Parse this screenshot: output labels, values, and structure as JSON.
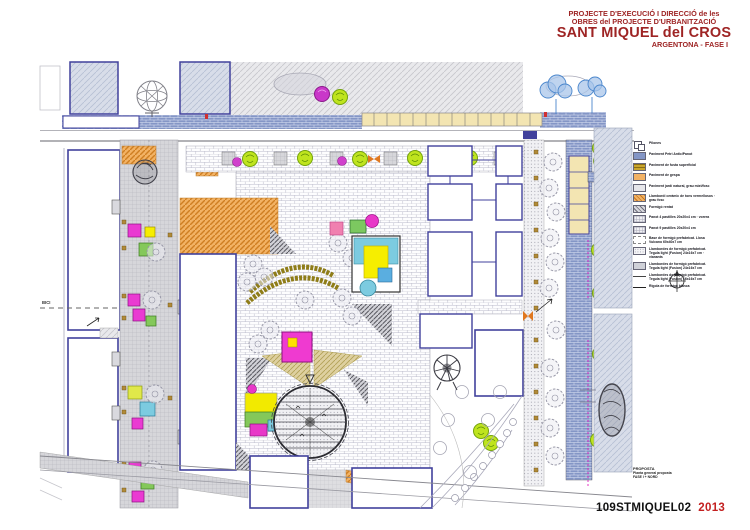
{
  "header": {
    "line1": "PROJECTE D'EXECUCIÓ I DIRECCIÓ de les",
    "line2": "OBRES del PROJECTE D'URBANITZACIÓ",
    "line3": "SANT MIQUEL del CROS",
    "line4": "ARGENTONA - FASE I"
  },
  "legend": {
    "items": [
      {
        "label": "Pilones",
        "swatch": "pilona-symbol"
      },
      {
        "label": "Paviment Petri Antic/Panot",
        "swatch": "solid-blue"
      },
      {
        "label": "Paviment de fusta superficial",
        "swatch": "stripes-gold"
      },
      {
        "label": "Paviment de gespa",
        "swatch": "solid-orange"
      },
      {
        "label": "Paviment jardí natural, grau mixt/fosc",
        "swatch": "solid-lightgray"
      },
      {
        "label": "Llambordí ceràmic de tons vermellosos · grau fosc",
        "swatch": "stripes-orange"
      },
      {
        "label": "Formigó rentat",
        "swatch": "hatch-gray"
      },
      {
        "label": "Panot 4 pastilles 20x20x4 cm · vorera",
        "swatch": "grid-light"
      },
      {
        "label": "Panot 9 pastilles 20x20x4 cm",
        "swatch": "grid-light"
      },
      {
        "label": "Base de formigó prefabricat. Llosa Vulcano 60x40x7 cm",
        "swatch": "dash-border"
      },
      {
        "label": "Llambordes de formigó prefabricat. Tegula light (Fusion) 24x16x7 cm · vianants",
        "swatch": "dots-light"
      },
      {
        "label": "Llambordes de formigó prefabricat. Tegula light (Fusion) 24x16x7 cm",
        "swatch": "dots-dense"
      },
      {
        "label": "Llambordes de formigó prefabricat. Tegula light (Fusion) 16x16x7 cm",
        "swatch": "line-thin"
      },
      {
        "label": "Rigola de formigó blanca",
        "swatch": "line-thick"
      }
    ]
  },
  "titleblock": {
    "name": "PROPOSTA",
    "line2": "Planta general proposta",
    "line3": "FASE I + NORD"
  },
  "sheet": {
    "code": "109STMIQUEL02",
    "year": "2013"
  },
  "plan": {
    "bici_label": "BICI"
  },
  "colors": {
    "title_red": "#9e2424",
    "year_red": "#c32020",
    "building_outline": "#41419c",
    "sidewalk_blue": "#8496c6",
    "paving_orange": "#f0a850",
    "pergola_cream": "#f3e5b2",
    "tree_green": "#bfe41e",
    "tree_magenta": "#c937c9",
    "play_yellow": "#f6ee00",
    "play_cyan": "#7ccbe0",
    "play_magenta": "#ea3ad2",
    "play_green": "#84c85a",
    "bench_olive": "#8f7d18",
    "hatch_band": "#d8dde9"
  }
}
